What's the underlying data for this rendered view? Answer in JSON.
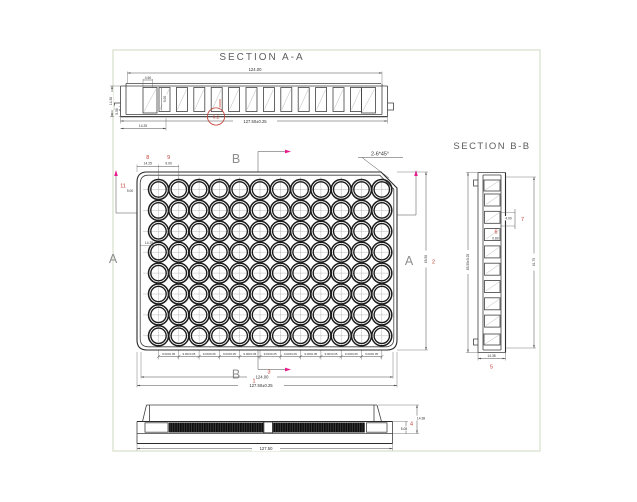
{
  "palette": {
    "line": "#3f3f3f",
    "annotation_red": "#c03a30",
    "section_arrow_magenta": "#e81b8d",
    "frame_green": "#dde4d2",
    "label_gray": "#8d8d8d"
  },
  "section_aa": {
    "title": "SECTION A-A",
    "cavities": 12,
    "dim_top_width": "124.00",
    "dim_overall_width": "127.50±0.25",
    "dim_height": "14.38",
    "dim_skirt_height": "5.08",
    "dim_end_offset": "14.25",
    "dim_rib_width": "4.50",
    "dim_well_depth": "9.00",
    "balloon_flatness": "0.2"
  },
  "plan": {
    "rows": 8,
    "cols": 12,
    "label_a": "A",
    "label_b": "B",
    "chamfer_note": "2-6*45°",
    "dim_col_offset": "14.25",
    "dim_col_pitch": "9.00",
    "dim_row_pitch": "9.00",
    "dim_row_offset": "14.25",
    "pitch_label": "9.00±0.05",
    "pitch_count": 11,
    "dim_body_width": "124.00",
    "dim_overall_width": "127.50±0.25",
    "dim_overall_height": "85.50",
    "balloons": {
      "b1": "1",
      "b2": "2",
      "b3": "3",
      "b8": "8",
      "b9": "9",
      "b11": "11"
    }
  },
  "section_bb": {
    "title": "SECTION B-B",
    "cavities": 8,
    "dim_overall_height": "85.50±0.25",
    "dim_inner_height": "81.70",
    "dim_rib": "4.00",
    "dim_gap": "0.80",
    "dim_height": "14.38",
    "balloons": {
      "b5": "5",
      "b6": "6",
      "b7": "7"
    }
  },
  "front_view": {
    "dim_height": "14.38",
    "dim_skirt_height": "5.08",
    "dim_overall_width": "127.50",
    "balloons": {
      "b4": "4"
    }
  }
}
